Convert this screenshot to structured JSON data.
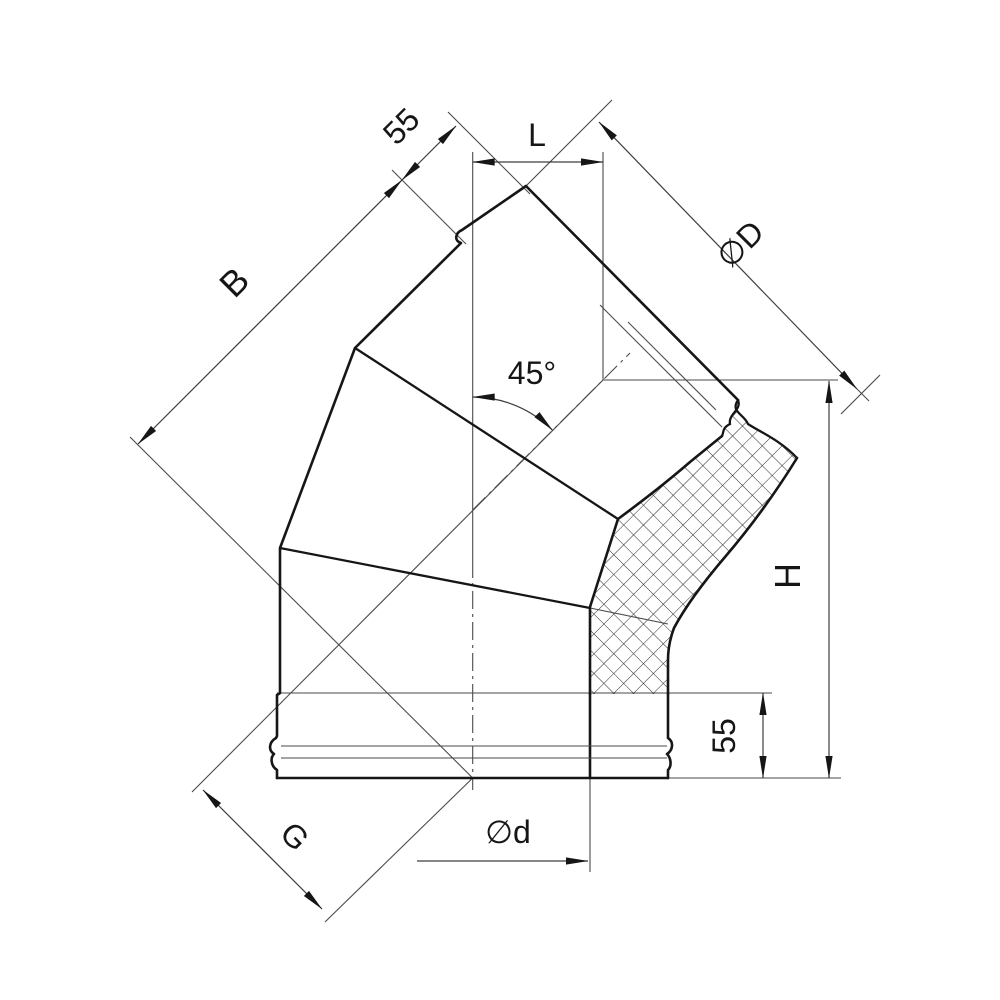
{
  "title": "45-degree insulated elbow technical drawing",
  "drawing": {
    "labels": {
      "b": "B",
      "socket_top": "55",
      "l": "L",
      "outer_diameter": "∅D",
      "angle": "45°",
      "height": "H",
      "socket_bottom": "55",
      "g": "G",
      "inner_diameter": "∅d"
    },
    "colors": {
      "background": "#ffffff",
      "outline": "#161616",
      "dimension": "#3d3d3d"
    }
  }
}
